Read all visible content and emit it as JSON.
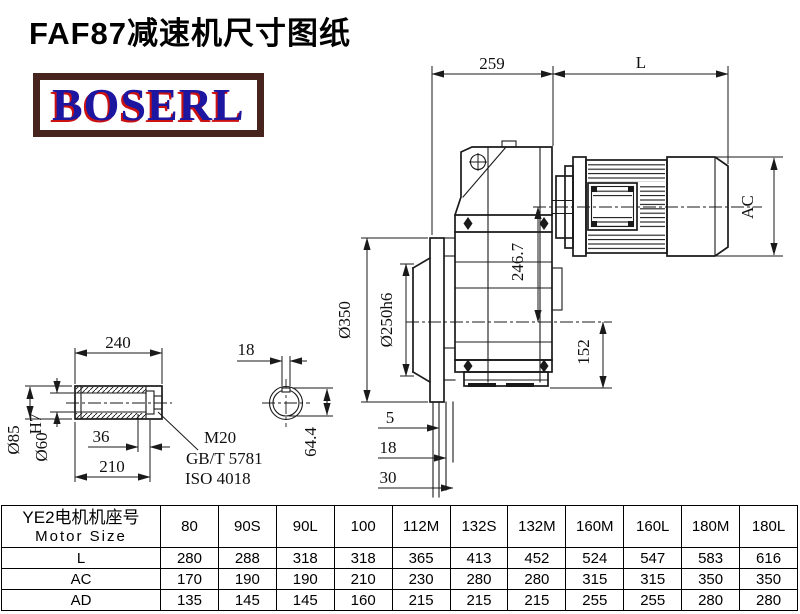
{
  "header": {
    "title": "FAF87减速机尺寸图纸",
    "logo_text": "BOSERL"
  },
  "colors": {
    "logo_border": "#47241e",
    "logo_blue": "#1c16a0",
    "logo_red": "#cc1111",
    "line": "#1a1a1a"
  },
  "drawing": {
    "dims": {
      "gear_unit_length": "259",
      "motor_length": "L",
      "motor_od": "AC",
      "center_height": "246.7",
      "foot_height": "152",
      "flange_od": "Ø350",
      "spigot_od": "Ø250h6",
      "pilot_5": "5",
      "flange_18": "18",
      "pilot_30": "30",
      "shaft_length": "240",
      "shaft_od": "Ø85",
      "bore_d": "Ø60",
      "bore_tol": "H7",
      "end_36": "36",
      "bore_210": "210",
      "thread": "M20",
      "standard_gb": "GB/T 5781",
      "standard_iso": "ISO 4018",
      "key_width": "18",
      "key_height": "64.4"
    }
  },
  "table": {
    "header": {
      "line1": "YE2电机机座号",
      "line2": "Motor Size"
    },
    "columns": [
      "80",
      "90S",
      "90L",
      "100",
      "112M",
      "132S",
      "132M",
      "160M",
      "160L",
      "180M",
      "180L"
    ],
    "rows": [
      {
        "label": "L",
        "values": [
          "280",
          "288",
          "318",
          "318",
          "365",
          "413",
          "452",
          "524",
          "547",
          "583",
          "616"
        ]
      },
      {
        "label": "AC",
        "values": [
          "170",
          "190",
          "190",
          "210",
          "230",
          "280",
          "280",
          "315",
          "315",
          "350",
          "350"
        ]
      },
      {
        "label": "AD",
        "values": [
          "135",
          "145",
          "145",
          "160",
          "215",
          "215",
          "215",
          "255",
          "255",
          "280",
          "280"
        ]
      }
    ]
  }
}
